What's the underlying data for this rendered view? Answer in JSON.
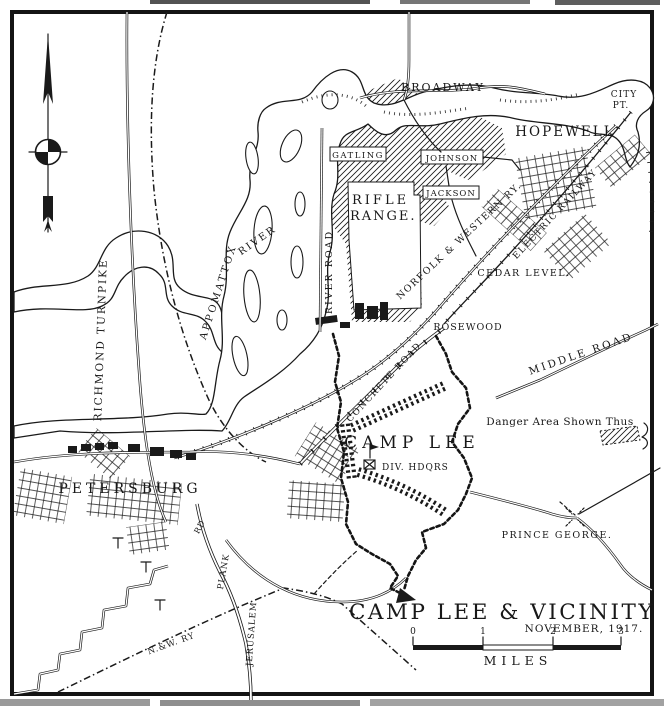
{
  "map": {
    "title": "CAMP LEE & VICINITY",
    "date": "NOVEMBER, 1917.",
    "colors": {
      "ink": "#1a1a1a",
      "paper": "#ffffff"
    },
    "scale": {
      "unit_label": "MILES",
      "ticks": [
        "0",
        "1",
        "2",
        "3"
      ]
    },
    "legend": {
      "danger": "Danger Area Shown Thus"
    },
    "labels": {
      "broadway": "BROADWAY",
      "city_pt1": "CITY",
      "city_pt2": "PT.",
      "hopewell": "HOPEWELL",
      "gatling": "GATLING",
      "johnson": "JOHNSON",
      "jackson": "JACKSON",
      "rifle": "RIFLE",
      "range": "RANGE.",
      "river_road": "RIVER ROAD",
      "appomattox": "APPOMATTOX",
      "river": "RIVER",
      "richmond_turnpike": "RICHMOND TURNPIKE",
      "norfolk_western": "NORFOLK & WESTERN RY.",
      "electric_railway": "ELECTRIC RAILWAY",
      "cedar_level": "CEDAR LEVEL.",
      "rosewood": "ROSEWOOD",
      "middle_road": "MIDDLE ROAD",
      "concrete_road": "CONCRETE ROAD",
      "camp_lee": "CAMP LEE",
      "div_hdqrs": "DIV. HDQRS",
      "petersburg": "PETERSBURG",
      "prince_george": "PRINCE GEORGE.",
      "jerusalem": "JERUSALEM",
      "plank": "PLANK",
      "rd": "RD",
      "nw_ry": "N.&W. RY"
    }
  }
}
